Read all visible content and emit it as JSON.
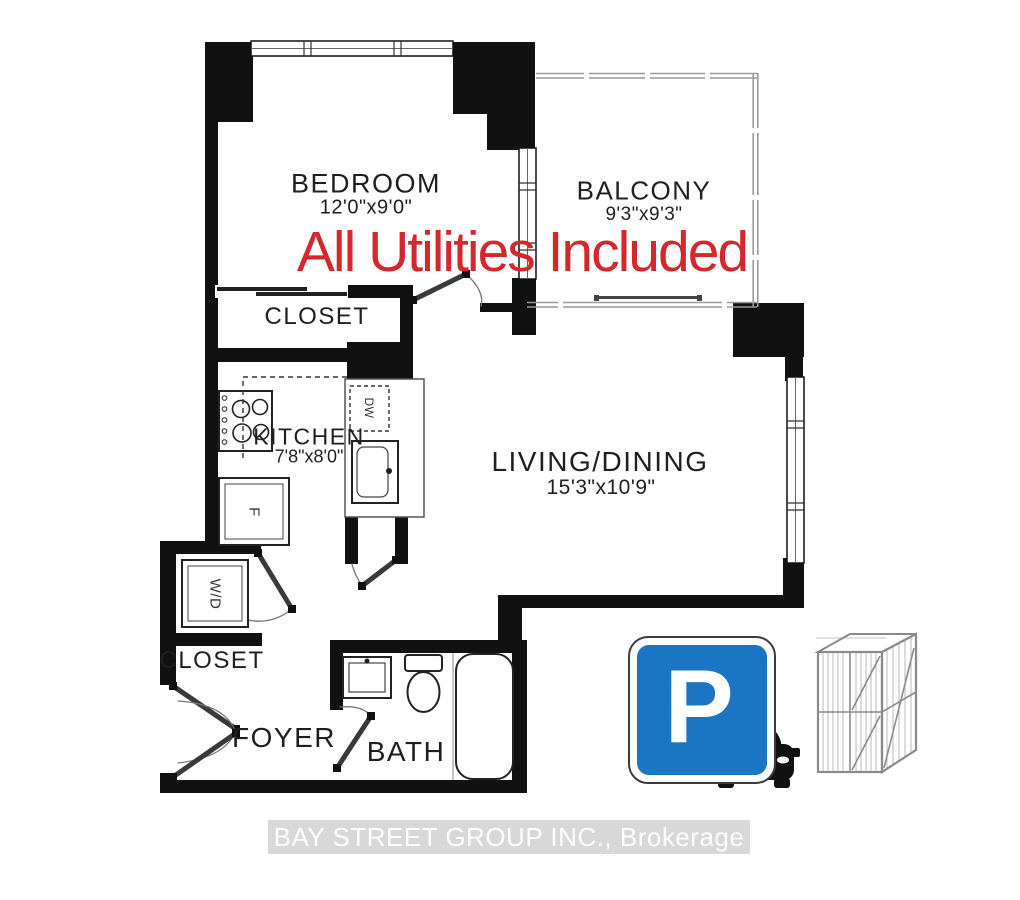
{
  "overlay": {
    "text": "All Utilities Included",
    "color": "#d4282c"
  },
  "rooms": {
    "bedroom": {
      "label": "BEDROOM",
      "dims": "12'0\"x9'0\""
    },
    "balcony": {
      "label": "BALCONY",
      "dims": "9'3\"x9'3\""
    },
    "bedroom_closet": {
      "label": "CLOSET"
    },
    "kitchen": {
      "label": "KITCHEN",
      "dims": "7'8\"x8'0\""
    },
    "living_dining": {
      "label": "LIVING/DINING",
      "dims": "15'3\"x10'9\""
    },
    "foyer_closet": {
      "label": "CLOSET"
    },
    "foyer": {
      "label": "FOYER"
    },
    "bath": {
      "label": "BATH"
    }
  },
  "appliances": {
    "washer_dryer": "W/D",
    "fridge": "F",
    "dishwasher": "DW"
  },
  "parking": {
    "letter": "P",
    "sign_blue": "#1a75c4"
  },
  "colors": {
    "wall": "#111111",
    "railing": "#9a9a9a",
    "overlay_red": "#d4282c"
  },
  "watermark": {
    "text": "BAY STREET GROUP INC., Brokerage"
  }
}
